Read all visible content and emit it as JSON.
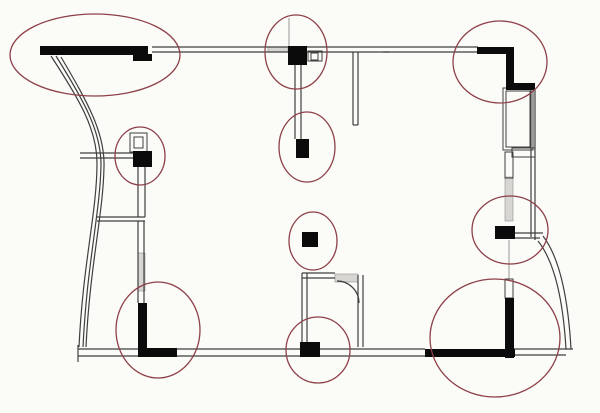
{
  "canvas": {
    "width": 600,
    "height": 413,
    "background": "#fbfbf8"
  },
  "style": {
    "wall_fill": "#0b0b0b",
    "line_color": "#3f3f3f",
    "light_line_color": "#a8a8a8",
    "gray_fill": "#d8d6d2",
    "gray_stroke": "#8f8f8f",
    "annotation_color": "#8d4048",
    "annotation_stroke_width": 1.3,
    "line_width": 1.2
  },
  "solid_walls": [
    {
      "x": 40,
      "y": 46,
      "w": 108,
      "h": 9,
      "name": "top-left-thick-wall"
    },
    {
      "x": 133,
      "y": 54,
      "w": 19,
      "h": 7,
      "name": "top-left-wall-step"
    },
    {
      "x": 477,
      "y": 47,
      "w": 36,
      "h": 7,
      "name": "top-right-thick-wall-horizontal"
    },
    {
      "x": 506,
      "y": 47,
      "w": 8,
      "h": 43,
      "name": "top-right-thick-wall-vertical"
    },
    {
      "x": 512,
      "y": 83,
      "w": 23,
      "h": 7,
      "name": "top-right-wall-step"
    },
    {
      "x": 505,
      "y": 298,
      "w": 9,
      "h": 60,
      "name": "bottom-right-thick-wall-vertical"
    },
    {
      "x": 425,
      "y": 349,
      "w": 90,
      "h": 8,
      "name": "bottom-right-thick-wall-horizontal"
    },
    {
      "x": 138,
      "y": 303,
      "w": 9,
      "h": 54,
      "name": "bottom-left-thick-wall-vertical"
    },
    {
      "x": 138,
      "y": 348,
      "w": 39,
      "h": 9,
      "name": "bottom-left-thick-wall-horizontal"
    }
  ],
  "markers": [
    {
      "x": 288,
      "y": 46,
      "w": 19,
      "h": 19,
      "name": "device-marker-top-center"
    },
    {
      "x": 296,
      "y": 139,
      "w": 13,
      "h": 19,
      "name": "device-marker-upper-center"
    },
    {
      "x": 133,
      "y": 151,
      "w": 19,
      "h": 16,
      "name": "device-marker-left-wall"
    },
    {
      "x": 302,
      "y": 232,
      "w": 16,
      "h": 15,
      "name": "device-marker-center"
    },
    {
      "x": 495,
      "y": 226,
      "w": 20,
      "h": 13,
      "name": "device-marker-right-wall"
    },
    {
      "x": 300,
      "y": 342,
      "w": 20,
      "h": 15,
      "name": "device-marker-bottom-center"
    }
  ],
  "lines": [
    {
      "x1": 152,
      "y1": 47,
      "x2": 478,
      "y2": 47
    },
    {
      "x1": 152,
      "y1": 52,
      "x2": 478,
      "y2": 52
    },
    {
      "x1": 353,
      "y1": 52,
      "x2": 353,
      "y2": 125
    },
    {
      "x1": 358,
      "y1": 52,
      "x2": 358,
      "y2": 125
    },
    {
      "x1": 353,
      "y1": 125,
      "x2": 358,
      "y2": 125
    },
    {
      "x1": 289,
      "y1": 18,
      "x2": 289,
      "y2": 46,
      "light": true
    },
    {
      "x1": 295,
      "y1": 65,
      "x2": 295,
      "y2": 139
    },
    {
      "x1": 301,
      "y1": 65,
      "x2": 301,
      "y2": 139
    },
    {
      "x1": 80,
      "y1": 153,
      "x2": 133,
      "y2": 153
    },
    {
      "x1": 80,
      "y1": 158,
      "x2": 133,
      "y2": 158
    },
    {
      "x1": 138,
      "y1": 167,
      "x2": 138,
      "y2": 217
    },
    {
      "x1": 145,
      "y1": 167,
      "x2": 145,
      "y2": 217
    },
    {
      "x1": 97,
      "y1": 217,
      "x2": 145,
      "y2": 217
    },
    {
      "x1": 97,
      "y1": 221,
      "x2": 145,
      "y2": 221
    },
    {
      "x1": 138,
      "y1": 221,
      "x2": 138,
      "y2": 303
    },
    {
      "x1": 144,
      "y1": 221,
      "x2": 144,
      "y2": 303
    },
    {
      "x1": 78,
      "y1": 349,
      "x2": 425,
      "y2": 349
    },
    {
      "x1": 78,
      "y1": 356,
      "x2": 425,
      "y2": 356
    },
    {
      "x1": 78,
      "y1": 345,
      "x2": 78,
      "y2": 362
    },
    {
      "x1": 514,
      "y1": 349,
      "x2": 573,
      "y2": 349
    },
    {
      "x1": 514,
      "y1": 355,
      "x2": 566,
      "y2": 355
    },
    {
      "x1": 302,
      "y1": 273,
      "x2": 302,
      "y2": 342
    },
    {
      "x1": 307,
      "y1": 273,
      "x2": 307,
      "y2": 342
    },
    {
      "x1": 302,
      "y1": 273,
      "x2": 335,
      "y2": 273
    },
    {
      "x1": 302,
      "y1": 278,
      "x2": 335,
      "y2": 278
    },
    {
      "x1": 358,
      "y1": 275,
      "x2": 358,
      "y2": 347
    },
    {
      "x1": 363,
      "y1": 275,
      "x2": 363,
      "y2": 347
    },
    {
      "x1": 515,
      "y1": 233,
      "x2": 543,
      "y2": 233
    },
    {
      "x1": 515,
      "y1": 238,
      "x2": 540,
      "y2": 238
    },
    {
      "x1": 531,
      "y1": 90,
      "x2": 531,
      "y2": 237
    },
    {
      "x1": 535,
      "y1": 90,
      "x2": 535,
      "y2": 240
    },
    {
      "x1": 509,
      "y1": 240,
      "x2": 509,
      "y2": 279,
      "light": true
    },
    {
      "x1": 383,
      "y1": 52,
      "x2": 390,
      "y2": 52
    }
  ],
  "curves": [
    {
      "d": "M51,56 C79,99 97,129 97,163 C97,212 83,262 79,347",
      "name": "left-curved-wall-outer"
    },
    {
      "d": "M56,56 C84,101 101,131 101,165 C100,214 87,263 83,347",
      "name": "left-curved-wall-middle"
    },
    {
      "d": "M61,57 C88,103 105,133 104,167 C103,216 90,264 86,347",
      "name": "left-curved-wall-inner"
    },
    {
      "d": "M543,236 C559,257 568,296 571,349",
      "name": "right-curved-wall-outer"
    },
    {
      "d": "M538,241 C554,261 563,299 566,349",
      "name": "right-curved-wall-inner"
    },
    {
      "d": "M337,281 A22,22 0 0 1 359,303",
      "name": "door-swing-arc"
    }
  ],
  "outlines": [
    {
      "x": 503,
      "y": 88,
      "w": 30,
      "h": 62,
      "name": "window-frame-outer"
    },
    {
      "x": 506,
      "y": 91,
      "w": 24,
      "h": 56,
      "name": "window-frame-inner"
    },
    {
      "x": 512,
      "y": 148,
      "w": 23,
      "h": 9,
      "name": "window-sill"
    },
    {
      "x": 505,
      "y": 152,
      "w": 8,
      "h": 26,
      "name": "window-mullion"
    },
    {
      "x": 505,
      "y": 279,
      "w": 8,
      "h": 19,
      "name": "window-segment-lower"
    },
    {
      "x": 308,
      "y": 51,
      "w": 14,
      "h": 10,
      "name": "outlet-symbol-top-outer"
    },
    {
      "x": 311,
      "y": 53,
      "w": 7,
      "h": 7,
      "name": "outlet-symbol-top-inner"
    },
    {
      "x": 130,
      "y": 133,
      "w": 17,
      "h": 19,
      "name": "outlet-symbol-left-outer"
    },
    {
      "x": 134,
      "y": 137,
      "w": 9,
      "h": 11,
      "name": "outlet-symbol-left-inner"
    }
  ],
  "gray_rects": [
    {
      "x": 268,
      "y": 47,
      "w": 20,
      "h": 5,
      "name": "hatched-wall-segment-top"
    },
    {
      "x": 505,
      "y": 177,
      "w": 8,
      "h": 44,
      "name": "hatched-window-strip-right"
    },
    {
      "x": 335,
      "y": 274,
      "w": 23,
      "h": 8,
      "name": "door-header-hatch"
    },
    {
      "x": 138,
      "y": 253,
      "w": 7,
      "h": 38,
      "name": "hatched-wall-strip-left"
    }
  ],
  "annotations": [
    {
      "cx": 95,
      "cy": 55,
      "rx": 85,
      "ry": 41,
      "name": "annotation-ellipse-top-left"
    },
    {
      "cx": 296,
      "cy": 52,
      "rx": 31,
      "ry": 37,
      "name": "annotation-ellipse-top-center"
    },
    {
      "cx": 307,
      "cy": 147,
      "rx": 28,
      "ry": 35,
      "name": "annotation-ellipse-upper-center"
    },
    {
      "cx": 140,
      "cy": 156,
      "rx": 25,
      "ry": 29,
      "name": "annotation-ellipse-left"
    },
    {
      "cx": 500,
      "cy": 62,
      "rx": 47,
      "ry": 41,
      "name": "annotation-ellipse-top-right"
    },
    {
      "cx": 510,
      "cy": 230,
      "rx": 38,
      "ry": 34,
      "name": "annotation-ellipse-right"
    },
    {
      "cx": 313,
      "cy": 241,
      "rx": 24,
      "ry": 29,
      "name": "annotation-ellipse-center"
    },
    {
      "cx": 318,
      "cy": 350,
      "rx": 32,
      "ry": 33,
      "name": "annotation-ellipse-bottom-center"
    },
    {
      "cx": 158,
      "cy": 330,
      "rx": 42,
      "ry": 48,
      "name": "annotation-ellipse-bottom-left"
    },
    {
      "cx": 495,
      "cy": 338,
      "rx": 65,
      "ry": 59,
      "name": "annotation-ellipse-bottom-right"
    }
  ]
}
